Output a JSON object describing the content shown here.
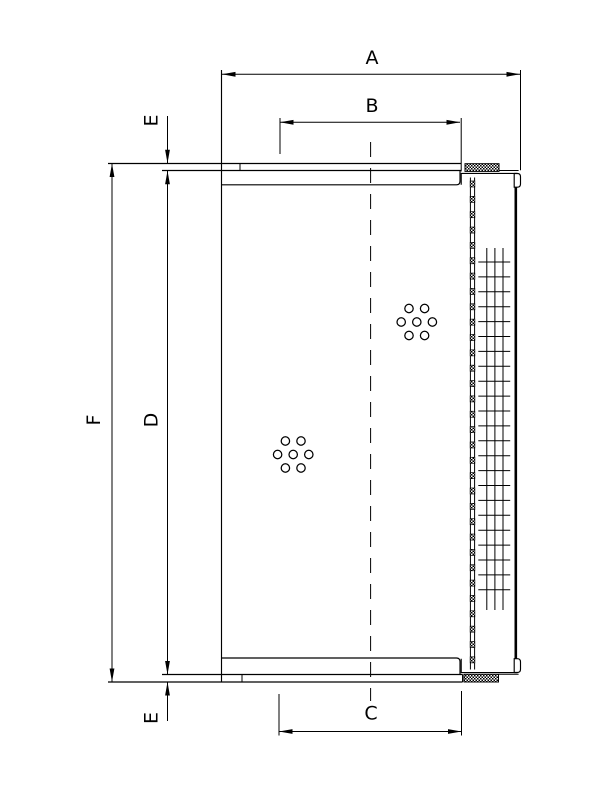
{
  "page": {
    "background": "#ffffff"
  },
  "drawing": {
    "kind": "technical dimensional drawing",
    "subject": "filter element cross-section",
    "ink": "#000000",
    "labels": {
      "A": "A",
      "B": "B",
      "C": "C",
      "D": "D",
      "E_top": "E",
      "E_bottom": "E",
      "F": "F"
    }
  }
}
